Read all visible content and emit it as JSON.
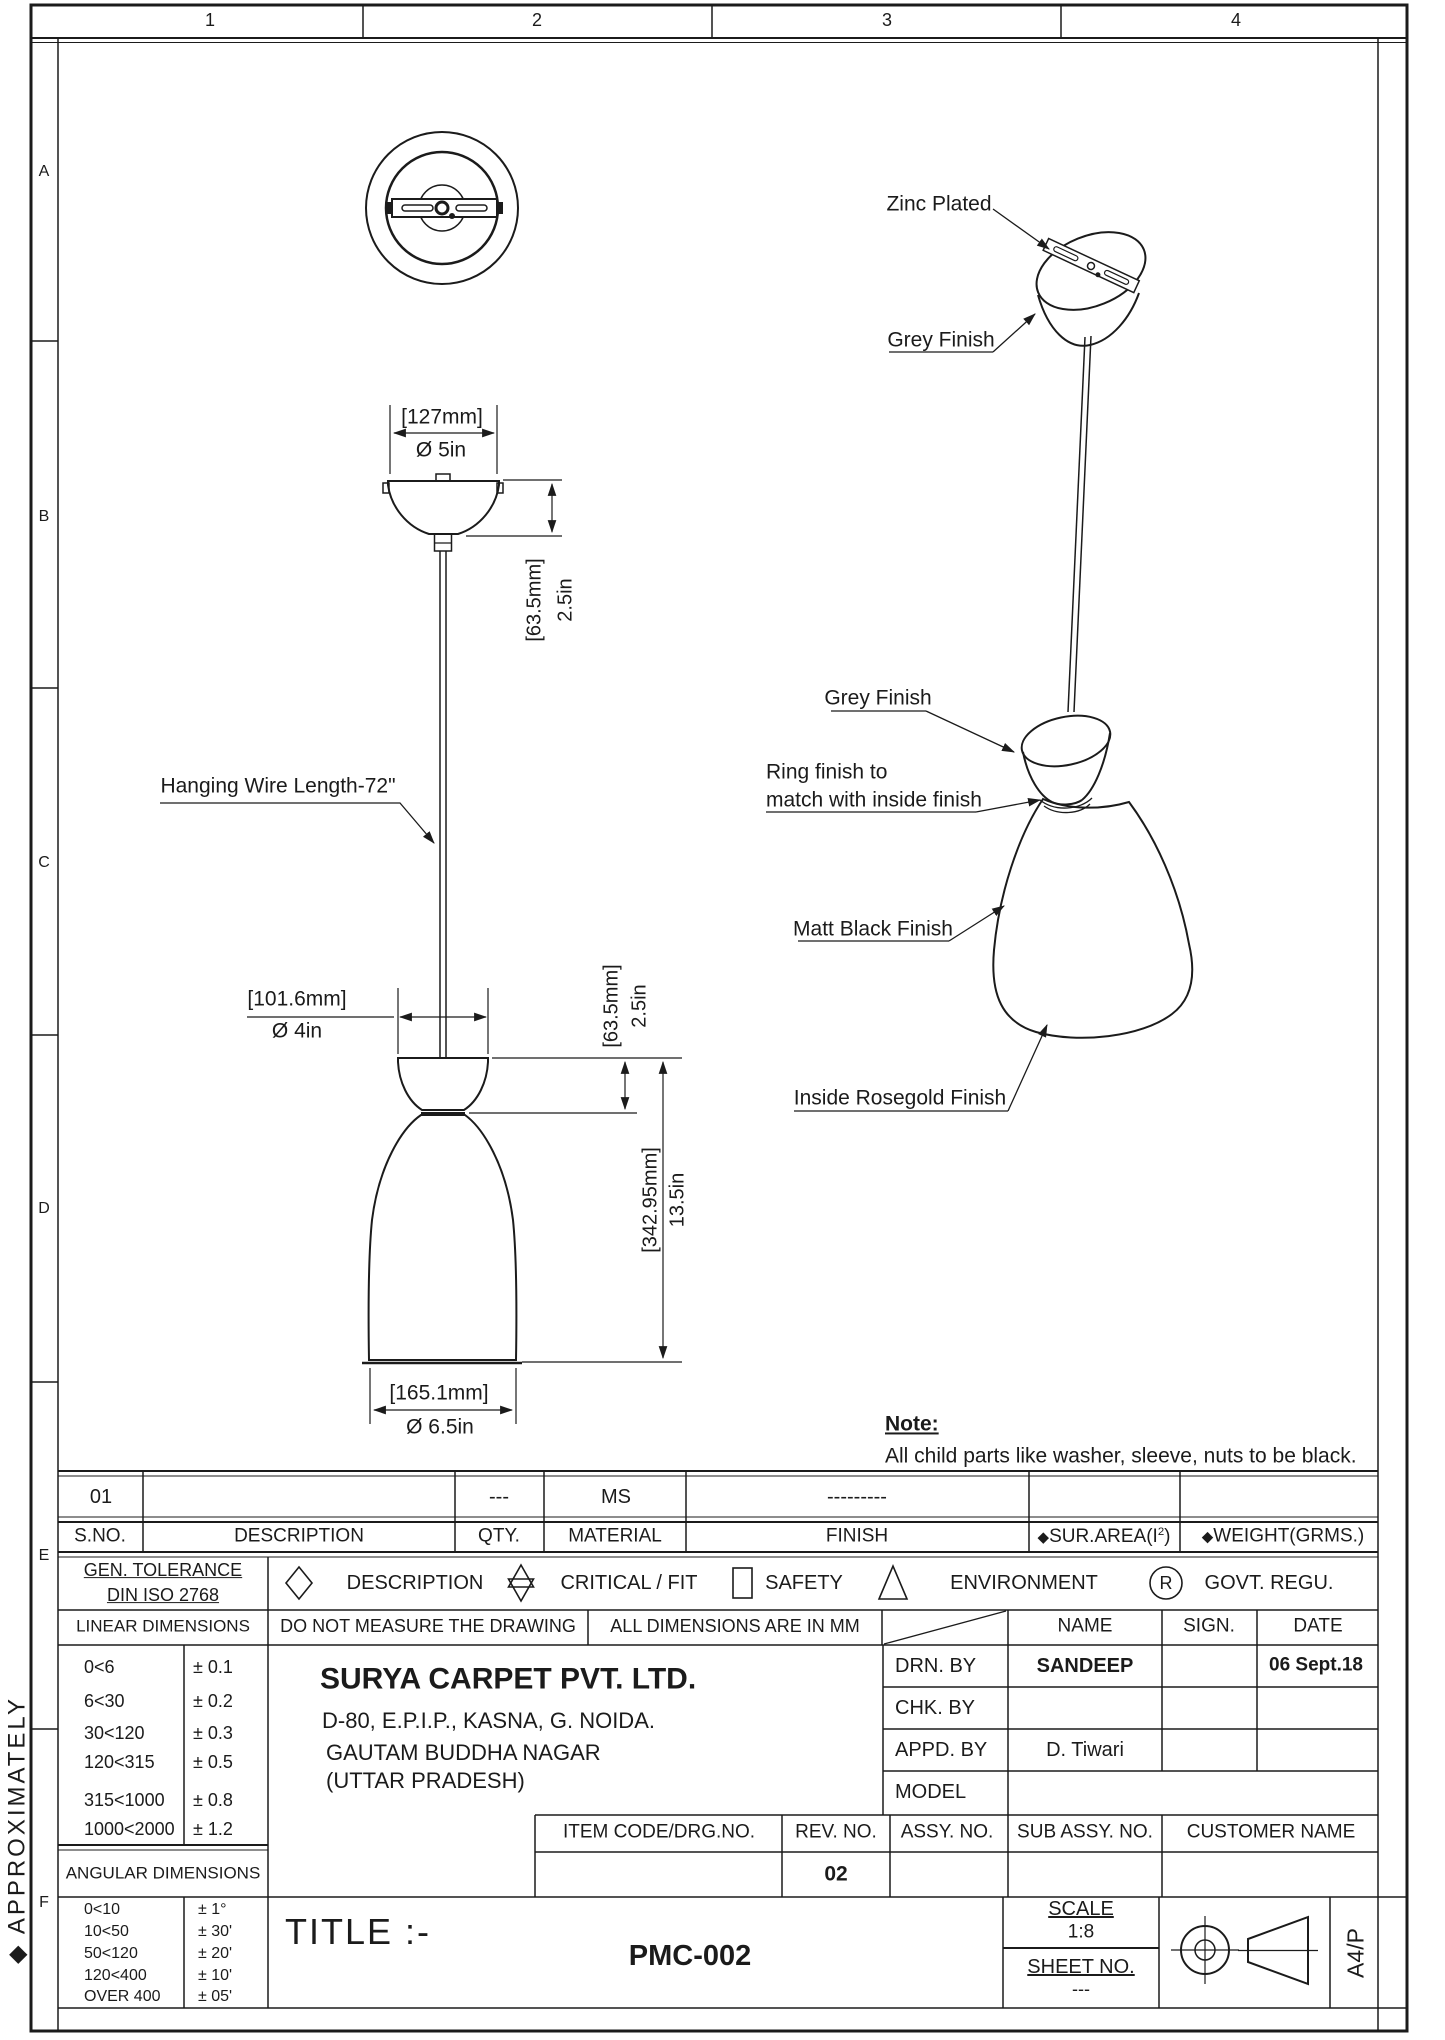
{
  "sheet": {
    "cols": [
      "1",
      "2",
      "3",
      "4"
    ],
    "rows": [
      "A",
      "B",
      "C",
      "D",
      "E",
      "F"
    ],
    "margin_note": "◆ APPROXIMATELY",
    "paper": "A4/P"
  },
  "drawing": {
    "callouts": {
      "zinc": "Zinc Plated",
      "grey_top": "Grey Finish",
      "grey_mid": "Grey Finish",
      "ring_l1": "Ring finish to",
      "ring_l2": "match with inside finish",
      "matt": "Matt Black Finish",
      "rosegold": "Inside Rosegold Finish",
      "wire": "Hanging Wire Length-72\""
    },
    "dims": {
      "canopy_mm": "[127mm]",
      "canopy_in": "Ø 5in",
      "canopy_h_mm": "[63.5mm]",
      "canopy_h_in": "2.5in",
      "holder_mm": "[101.6mm]",
      "holder_in": "Ø 4in",
      "holder_h_mm": "[63.5mm]",
      "holder_h_in": "2.5in",
      "shade_h_mm": "[342.95mm]",
      "shade_h_in": "13.5in",
      "shade_mm": "[165.1mm]",
      "shade_in": "Ø 6.5in"
    },
    "note": {
      "title": "Note:",
      "body": "All child parts like washer, sleeve, nuts to be black."
    }
  },
  "parts": {
    "values": {
      "sno": "01",
      "qty": "---",
      "material": "MS",
      "finish": "---------"
    },
    "headers": {
      "sno": "S.NO.",
      "description": "DESCRIPTION",
      "qty": "QTY.",
      "material": "MATERIAL",
      "finish": "FINISH",
      "bullet": "◆",
      "sur_area_pre": "SUR.AREA(I",
      "sur_area_sup": "2",
      "sur_area_post": ")",
      "weight": "WEIGHT(GRMS.)"
    }
  },
  "tol": {
    "gen1": "GEN. TOLERANCE",
    "gen2": "DIN ISO 2768",
    "sym_desc": "DESCRIPTION",
    "sym_crit": "CRITICAL / FIT",
    "sym_safe": "SAFETY",
    "sym_env": "ENVIRONMENT",
    "sym_govt": "GOVT. REGU.",
    "sym_r": "R",
    "linear_title": "LINEAR DIMENSIONS",
    "no_measure": "DO NOT MEASURE THE DRAWING",
    "all_mm": "ALL DIMENSIONS ARE IN MM",
    "name": "NAME",
    "sign": "SIGN.",
    "date": "DATE",
    "linear": [
      {
        "r": "0<6",
        "v": "± 0.1"
      },
      {
        "r": "6<30",
        "v": "± 0.2"
      },
      {
        "r": "30<120",
        "v": "± 0.3"
      },
      {
        "r": "120<315",
        "v": "± 0.5"
      },
      {
        "r": "315<1000",
        "v": "± 0.8"
      },
      {
        "r": "1000<2000",
        "v": "± 1.2"
      }
    ],
    "angular_title": "ANGULAR DIMENSIONS",
    "angular": [
      {
        "r": "0<10",
        "v": "± 1°"
      },
      {
        "r": "10<50",
        "v": "± 30'"
      },
      {
        "r": "50<120",
        "v": "± 20'"
      },
      {
        "r": "120<400",
        "v": "± 10'"
      },
      {
        "r": "OVER 400",
        "v": "± 05'"
      }
    ]
  },
  "company": {
    "name": "SURYA CARPET PVT. LTD.",
    "addr1": "D-80, E.P.I.P., KASNA, G. NOIDA.",
    "addr2": "GAUTAM BUDDHA NAGAR",
    "addr3": "(UTTAR PRADESH)"
  },
  "approval": {
    "drn": "DRN. BY",
    "drn_name": "SANDEEP",
    "drn_date": "06 Sept.18",
    "chk": "CHK. BY",
    "appd": "APPD. BY",
    "appd_name": "D. Tiwari",
    "model": "MODEL"
  },
  "item": {
    "code": "ITEM CODE/DRG.NO.",
    "rev": "REV. NO.",
    "assy": "ASSY. NO.",
    "sub": "SUB ASSY. NO.",
    "customer": "CUSTOMER NAME",
    "rev_val": "02"
  },
  "titleblock": {
    "title": "TITLE :-",
    "number": "PMC-002",
    "scale_label": "SCALE",
    "scale": "1:8",
    "sheet_label": "SHEET NO.",
    "sheet": "---"
  }
}
